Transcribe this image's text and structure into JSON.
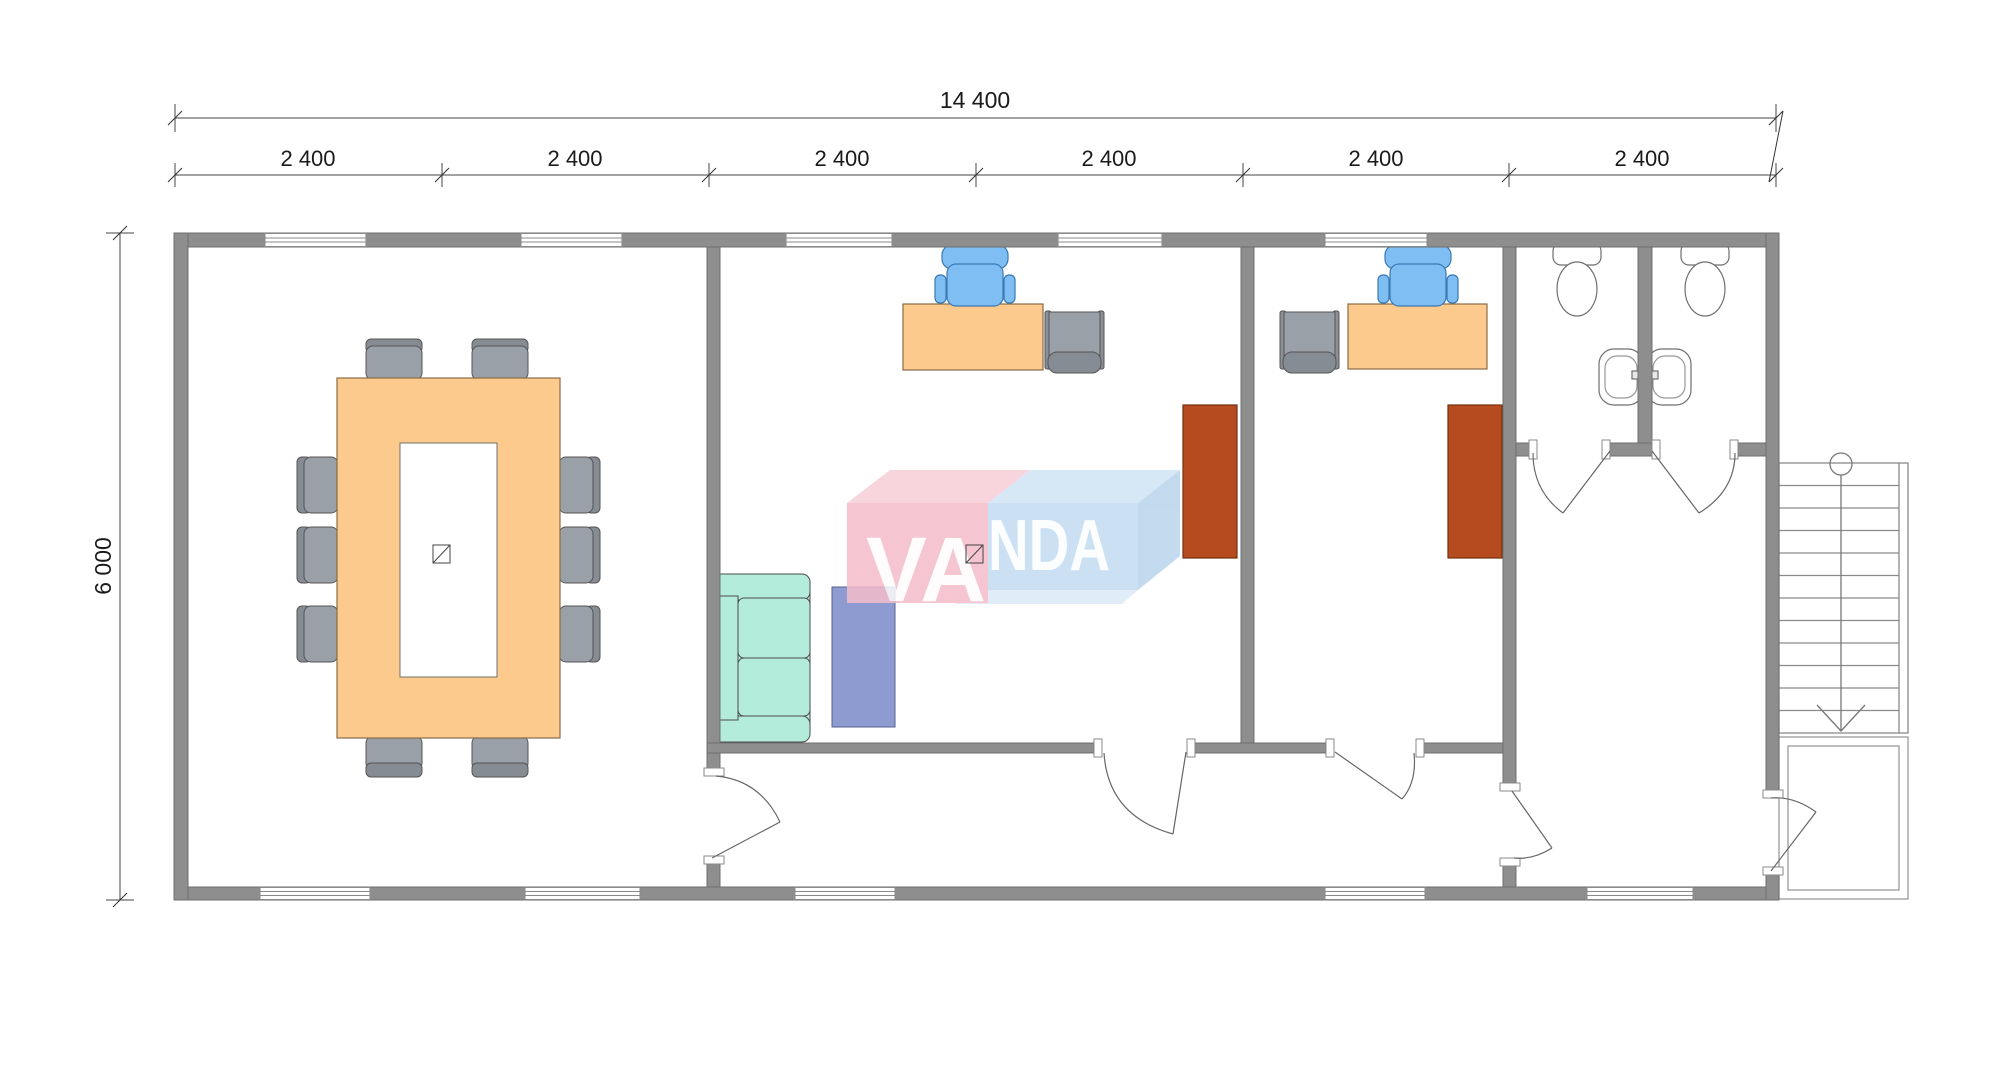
{
  "watermark": {
    "full": "VANDA",
    "part1": "VA",
    "part2": "NDA"
  },
  "dimensions": {
    "overall_width": "14 400",
    "overall_height": "6 000",
    "segments": [
      "2 400",
      "2 400",
      "2 400",
      "2 400",
      "2 400",
      "2 400"
    ]
  },
  "colors": {
    "wall": "#8e8e8e",
    "wall_stroke": "#6f6f6f",
    "wood_furniture": "#fcca8c",
    "chair_gray": "#9aa0a8",
    "chair_back_gray": "#868c94",
    "office_chair_blue": "#7fbef2",
    "sofa_mint": "#b4ecdc",
    "rug_blue": "#8e9bd1",
    "cabinet_brown": "#b54b1e",
    "logo_pink": "#f4bccb",
    "logo_blue": "#c3dcf2",
    "dimension_text": "#1a1a1a"
  }
}
